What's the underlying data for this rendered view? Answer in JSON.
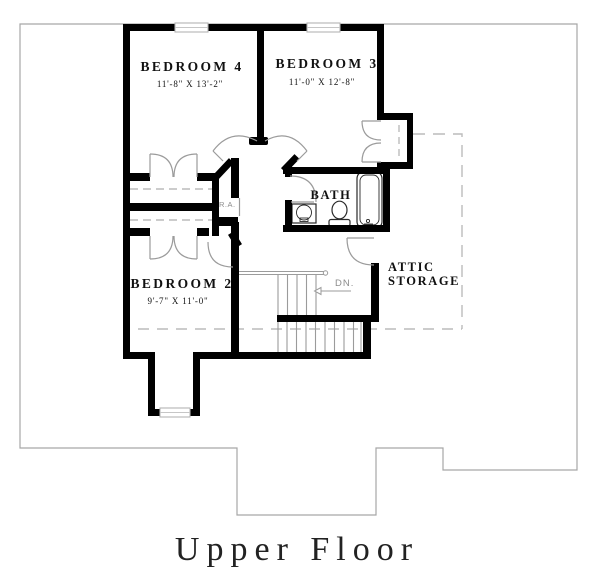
{
  "title": "Upper Floor",
  "rooms": {
    "bedroom4": {
      "name": "BEDROOM 4",
      "dims": "11'-8\" X 13'-2\""
    },
    "bedroom3": {
      "name": "BEDROOM 3",
      "dims": "11'-0\" X 12'-8\""
    },
    "bedroom2": {
      "name": "BEDROOM 2",
      "dims": "9'-7\" X 11'-0\""
    },
    "bath": {
      "name": "BATH"
    },
    "attic_storage": {
      "line1": "ATTIC",
      "line2": "STORAGE"
    }
  },
  "annotations": {
    "down": "DN.",
    "return_air": "R.A."
  },
  "colors": {
    "background": "#ffffff",
    "walls": "#000000",
    "roof_outline": "#a6a6a6",
    "stair_lines": "#9b9b9b",
    "dashed_lines": "#bcbcbc",
    "door_swings": "#9b9b9b",
    "fixture_lines": "#2a2a2a",
    "label_text": "#111111",
    "muted_text": "#8c8c8c"
  }
}
